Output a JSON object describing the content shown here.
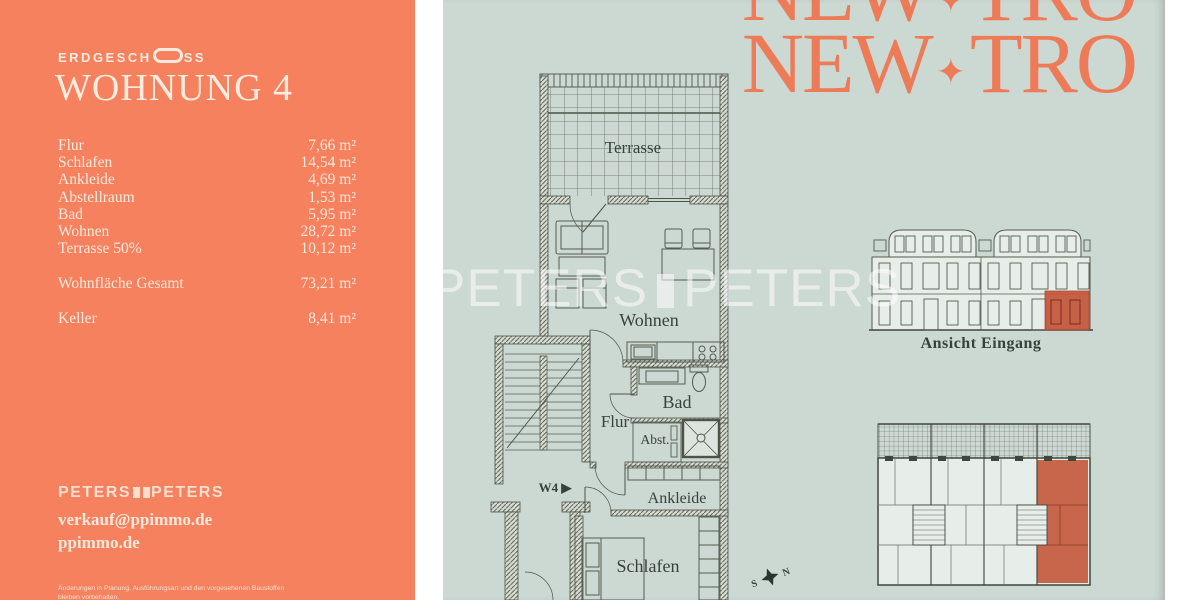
{
  "colors": {
    "coral_panel": "#f5815f",
    "sage_panel": "#ccd8d2",
    "cream_text": "#fbe9dc",
    "logo_coral": "#ee7b58",
    "plan_ink": "#4c5347",
    "highlight_red": "#c4563a",
    "watermark_white": "rgba(255,255,255,0.55)"
  },
  "left_panel": {
    "floor_label_pre": "ERDGESCH",
    "floor_label_post": "SS",
    "title": "WOHNUNG 4",
    "rooms": [
      {
        "label": "Flur",
        "value": "7,66 m²"
      },
      {
        "label": "Schlafen",
        "value": "14,54 m²"
      },
      {
        "label": "Ankleide",
        "value": "4,69 m²"
      },
      {
        "label": "Abstellraum",
        "value": "1,53 m²"
      },
      {
        "label": "Bad",
        "value": "5,95 m²"
      },
      {
        "label": "Wohnen",
        "value": "28,72 m²"
      },
      {
        "label": "Terrasse 50%",
        "value": "10,12 m²"
      }
    ],
    "total": {
      "label": "Wohnfläche Gesamt",
      "value": "73,21 m²"
    },
    "keller": {
      "label": "Keller",
      "value": "8,41 m²"
    },
    "brand": {
      "left": "PETERS",
      "right": "PETERS"
    },
    "email": "verkauf@ppimmo.de",
    "website": "ppimmo.de",
    "disclaimer1": "Änderungen in Planung, Ausführungsart und den vorgesehenen Baustoffen",
    "disclaimer2": "bleiben vorbehalten."
  },
  "right_panel": {
    "logo": {
      "word1": "NEW",
      "star": "✦",
      "word2": "TRO"
    },
    "watermark": {
      "left": "PETERS",
      "right": "PETERS"
    },
    "plan_labels": {
      "terrasse": "Terrasse",
      "wohnen": "Wohnen",
      "bad": "Bad",
      "flur": "Flur",
      "abst": "Abst.",
      "ankleide": "Ankleide",
      "schlafen": "Schlafen",
      "unit_tag": "W4 ▶"
    },
    "elevation_caption": "Ansicht Eingang",
    "compass": {
      "s": "S",
      "n": "N"
    }
  }
}
